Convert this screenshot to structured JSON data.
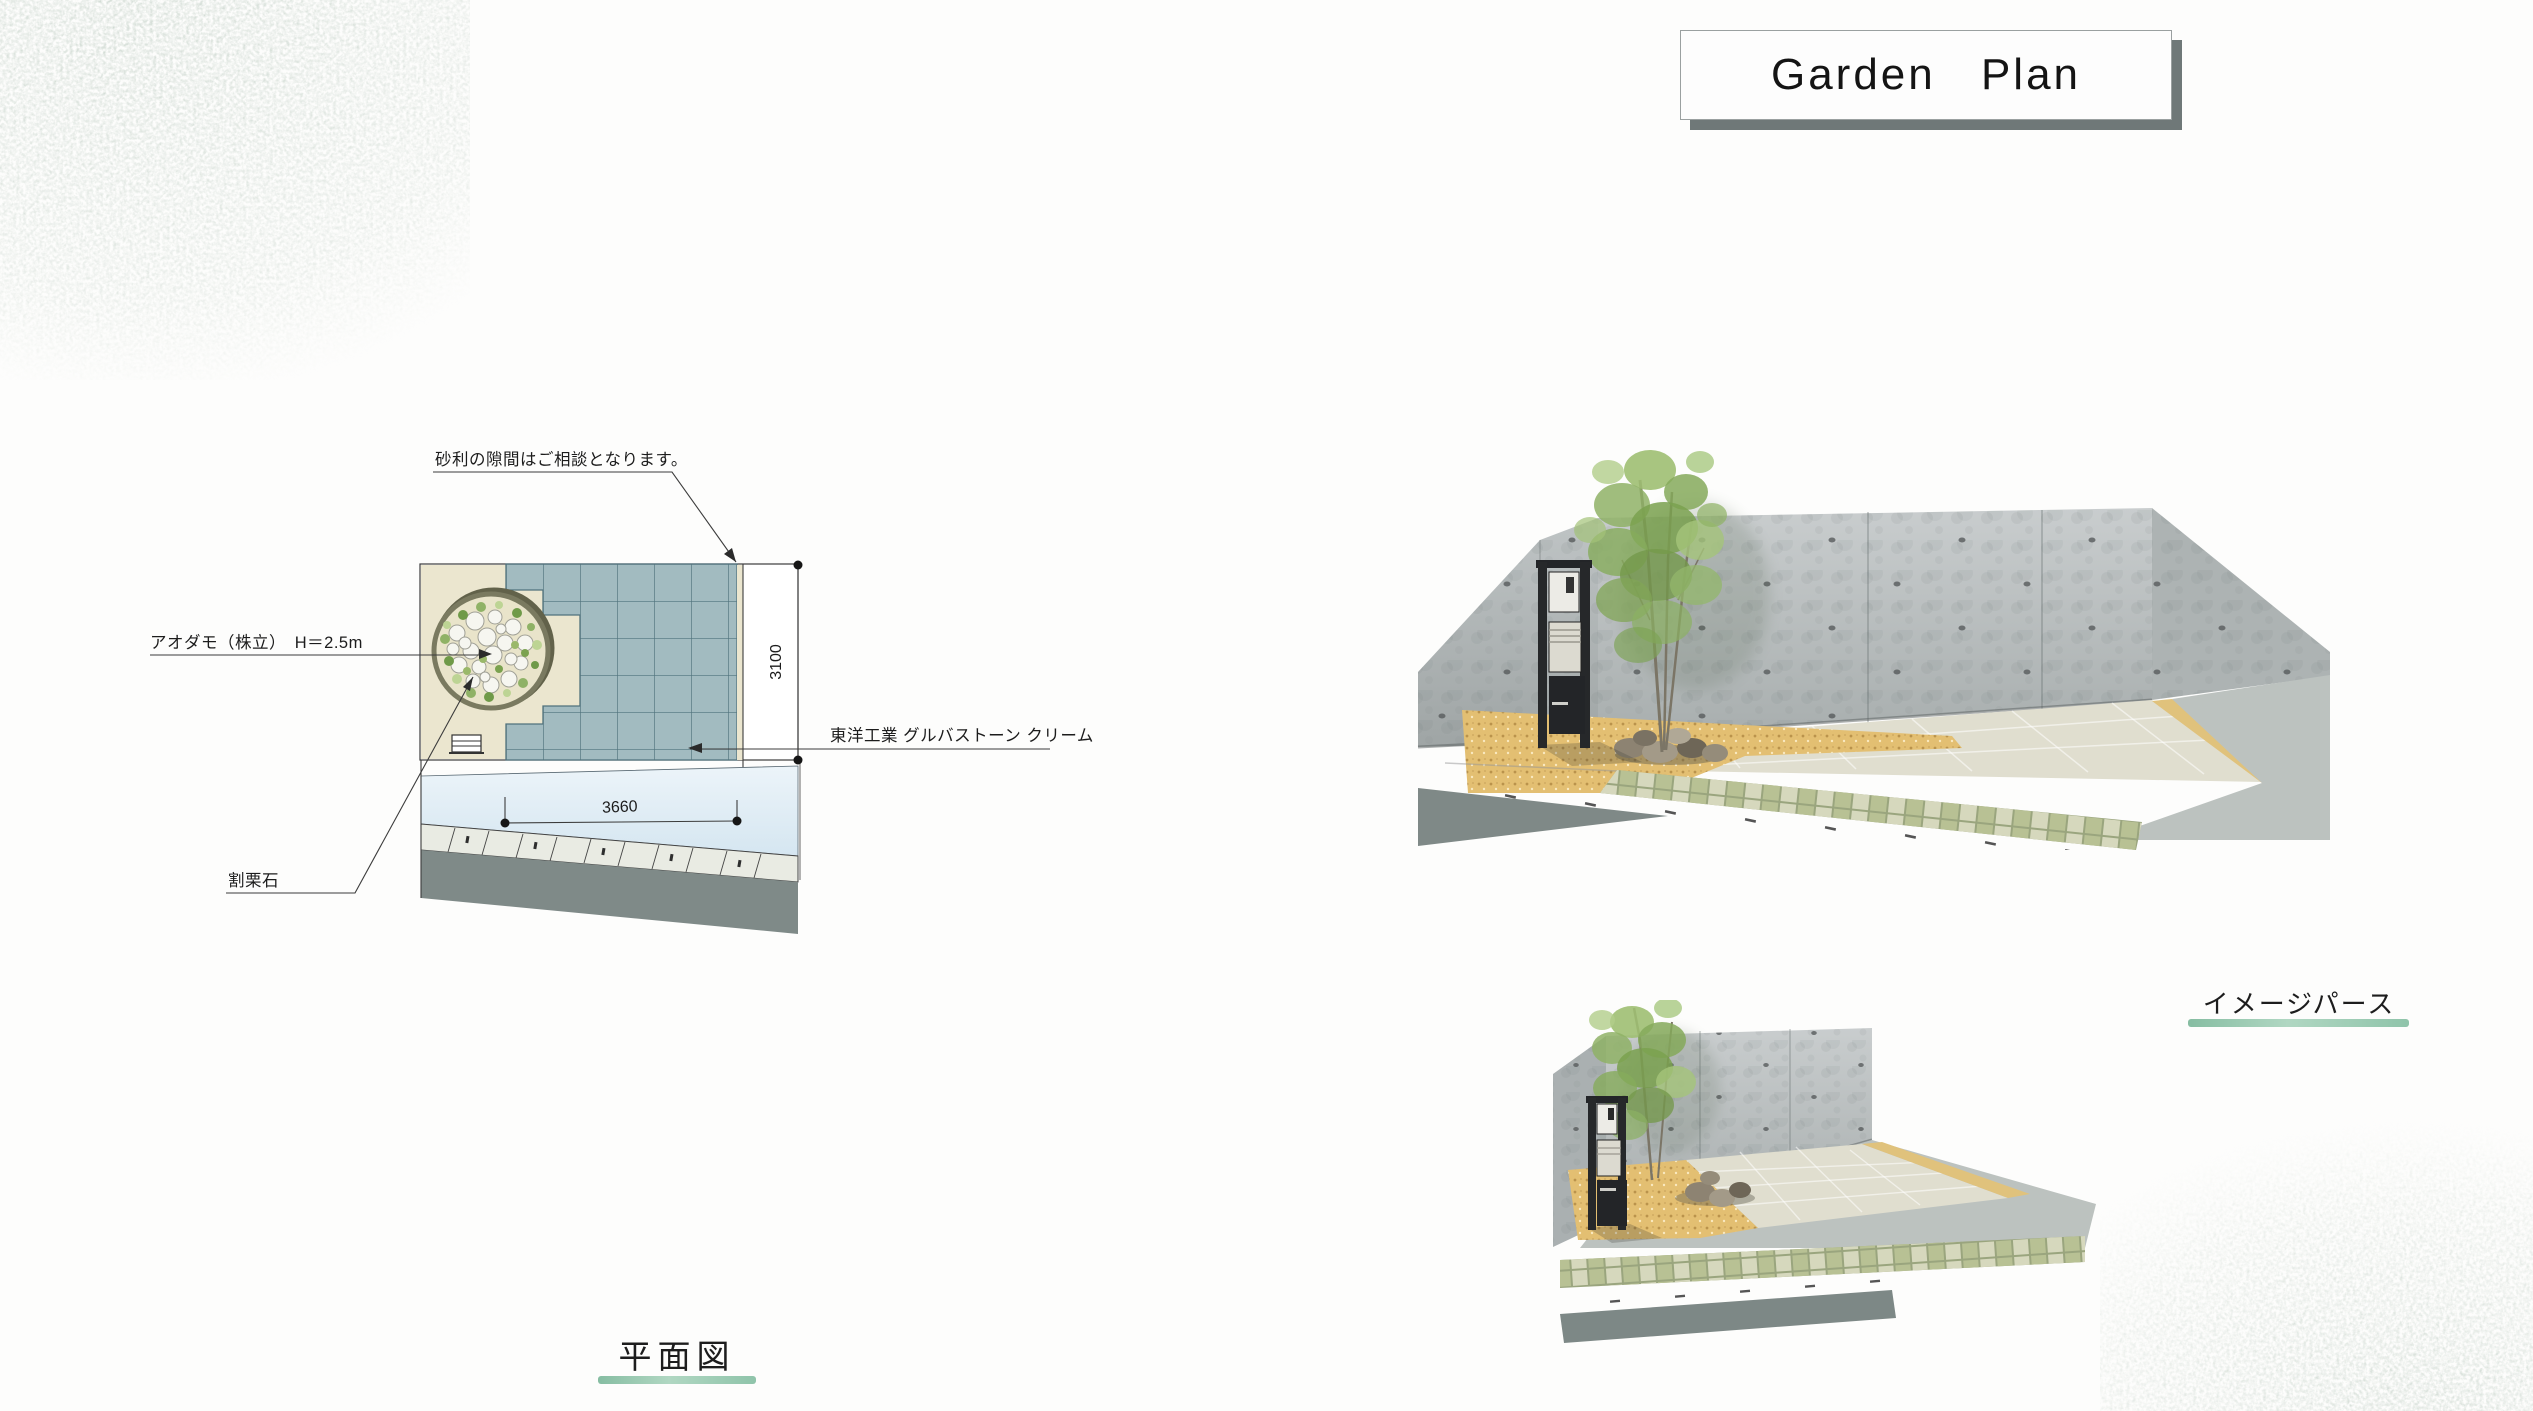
{
  "title": {
    "text": "Garden Plan"
  },
  "plan_view": {
    "section_label": "平面図",
    "annotations": {
      "gravel_note": "砂利の隙間はご相談となります。",
      "tree_label": "アオダモ（株立）　H＝2.5m",
      "crushed_stone_label": "割栗石",
      "paving_label": "東洋工業 グルバストーン クリーム"
    },
    "dimensions": {
      "width_mm": "3660",
      "depth_mm": "3100"
    }
  },
  "perspective_view": {
    "section_label": "イメージパース"
  },
  "colors": {
    "accent_bar_green": "#8fc4aa",
    "title_shadow_gray": "#6f7878",
    "plan_tile_fill": "#a2bbc0",
    "plan_tile_line": "#50727c",
    "plan_gravel_cream": "#ebe6cf",
    "road_asphalt_gray": "#7f8a88",
    "road_blue_band": "#d5e6f1",
    "render_wall_gray": "#b4baba",
    "render_gravel_tan": "#e3bf72",
    "render_paving_cream": "#e0decf",
    "render_cobble_green": "#b8c194",
    "render_pole_black": "#232528"
  }
}
